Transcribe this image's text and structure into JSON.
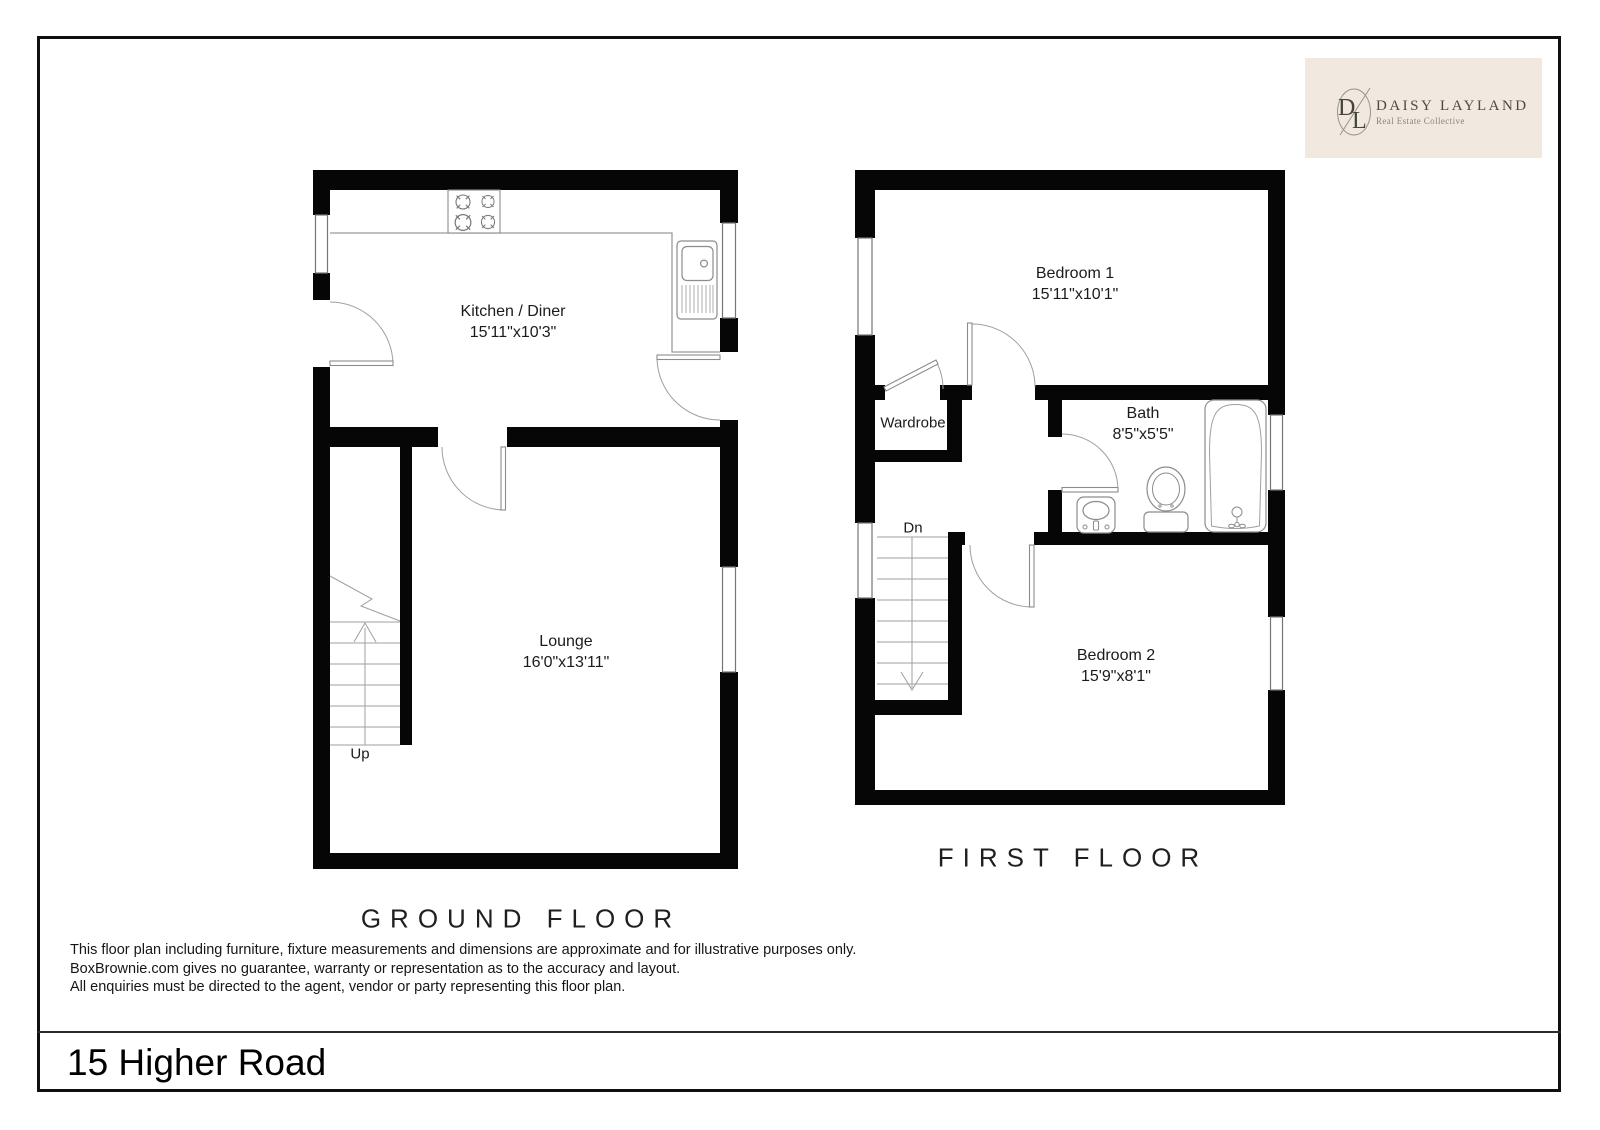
{
  "page": {
    "address": "15 Higher Road",
    "disclaimer": [
      "This floor plan including furniture, fixture measurements and dimensions are approximate and for illustrative purposes only.",
      "BoxBrownie.com gives no guarantee, warranty or representation as to the accuracy and layout.",
      "All enquiries must be directed to the agent, vendor or party representing this floor plan."
    ]
  },
  "logo": {
    "monogram_left": "D",
    "monogram_right": "L",
    "name": "DAISY LAYLAND",
    "tagline": "Real Estate Collective"
  },
  "ground_floor": {
    "title": "GROUND FLOOR",
    "kitchen_name": "Kitchen / Diner",
    "kitchen_dims": "15'11\"x10'3\"",
    "lounge_name": "Lounge",
    "lounge_dims": "16'0\"x13'11\"",
    "stairs_label": "Up"
  },
  "first_floor": {
    "title": "FIRST FLOOR",
    "bedroom1_name": "Bedroom 1",
    "bedroom1_dims": "15'11\"x10'1\"",
    "bath_name": "Bath",
    "bath_dims": "8'5\"x5'5\"",
    "bedroom2_name": "Bedroom 2",
    "bedroom2_dims": "15'9\"x8'1\"",
    "wardrobe_name": "Wardrobe",
    "stairs_label": "Dn"
  },
  "colors": {
    "wall": "#060606",
    "fixture_line": "#8c8c8c",
    "thin_line": "#9f9f9f",
    "logo_bg": "#f1e8e0",
    "logo_text": "#4b4b45"
  }
}
